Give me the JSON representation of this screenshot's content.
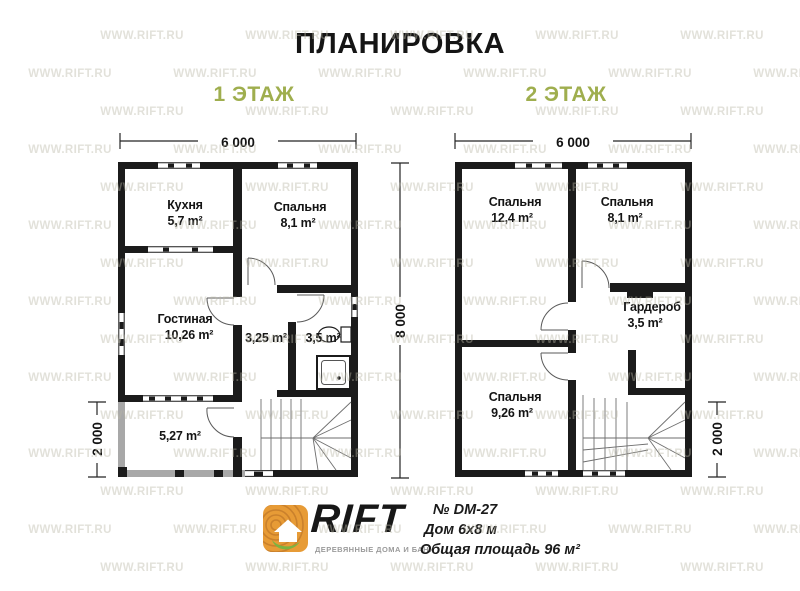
{
  "title": "ПЛАНИРОВКА",
  "watermark": "WWW.RIFT.RU",
  "dimensions": {
    "width_floor1": "6 000",
    "width_floor2": "6 000",
    "depth": "8 000",
    "veranda_left": "2 000",
    "veranda_right": "2 000"
  },
  "floors": [
    {
      "label": "1 ЭТАЖ",
      "rooms": [
        {
          "name": "Кухня",
          "area": "5,7 m²"
        },
        {
          "name": "Спальня",
          "area": "8,1 m²"
        },
        {
          "name": "Гостиная",
          "area": "10,26 m²"
        },
        {
          "name": "",
          "area": "3,25 m²"
        },
        {
          "name": "",
          "area": "3,5 m²"
        },
        {
          "name": "",
          "area": "5,27 m²"
        }
      ]
    },
    {
      "label": "2 ЭТАЖ",
      "rooms": [
        {
          "name": "Спальня",
          "area": "12,4 m²"
        },
        {
          "name": "Спальня",
          "area": "8,1 m²"
        },
        {
          "name": "Гардероб",
          "area": "3,5 m²"
        },
        {
          "name": "Спальня",
          "area": "9,26 m²"
        }
      ]
    }
  ],
  "footer": {
    "logo": {
      "brand": "RIFT",
      "tagline": "ДЕРЕВЯННЫЕ ДОМА И БАНИ"
    },
    "project_no": "№ DM-27",
    "house_size": "Дом 6х8 м",
    "total_area": "Общая площадь 96 м²"
  },
  "colors": {
    "accent_green": "#9fae4e",
    "wall_black": "#1b1b1b",
    "veranda_gray": "#a8a8a8",
    "logo_wood": "#e79b36",
    "logo_leaf": "#7cb342",
    "watermark_gray": "#bab7a6"
  }
}
